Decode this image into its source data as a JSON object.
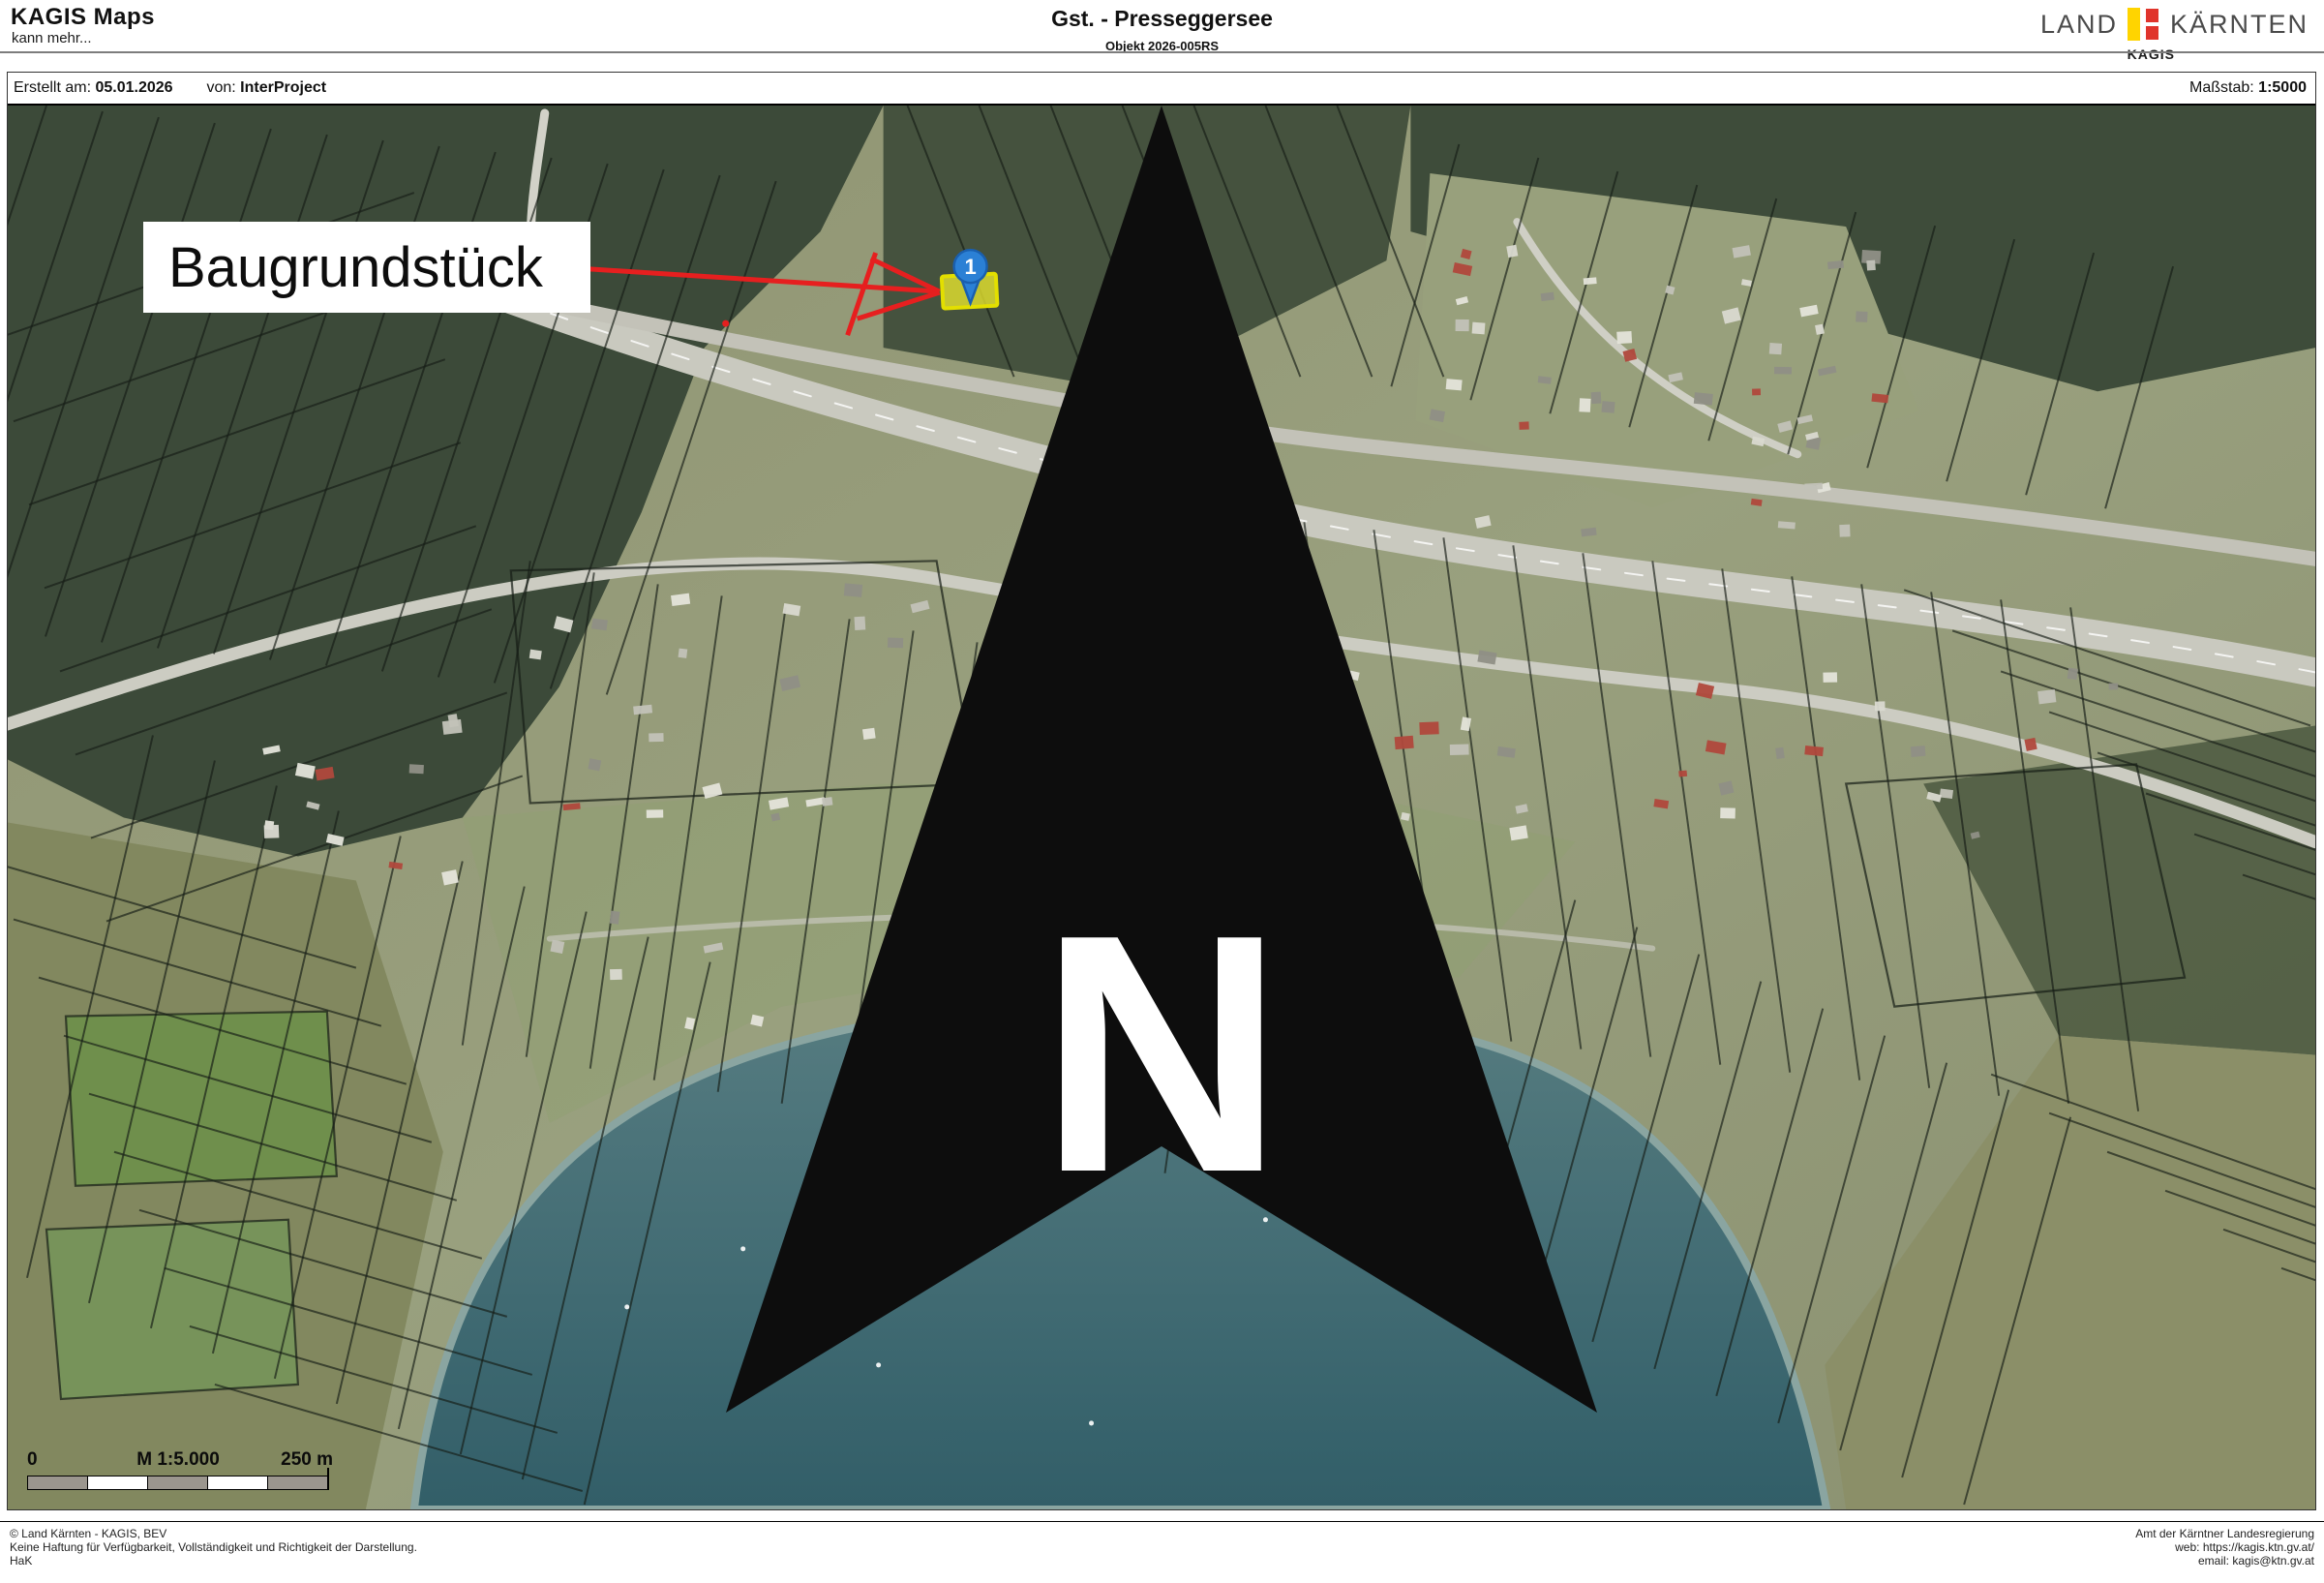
{
  "header": {
    "app_title": "KAGIS Maps",
    "app_subtitle": "kann mehr...",
    "doc_title": "Gst. - Presseggersee",
    "doc_subtitle": "Objekt 2026-005RS",
    "logo": {
      "land": "LAND",
      "kaernten": "KÄRNTEN",
      "kagis": "KAGIS"
    }
  },
  "meta": {
    "created_label": "Erstellt am:",
    "created_value": "05.01.2026",
    "by_label": "von:",
    "by_value": "InterProject",
    "scale_label": "Maßstab:",
    "scale_value": "1:5000"
  },
  "map": {
    "annotation_label": "Baugrundstück",
    "marker_number": "1",
    "place_label": "Hermagor-Pressegger See",
    "north_label": "N",
    "scalebar": {
      "zero": "0",
      "scale_text": "M 1:5.000",
      "distance": "250 m"
    }
  },
  "footer": {
    "left_lines": [
      "© Land Kärnten - KAGIS, BEV",
      "Keine Haftung für Verfügbarkeit, Vollständigkeit und Richtigkeit der Darstellung.",
      "HaK"
    ],
    "right_lines": [
      "Amt der Kärntner Landesregierung",
      "web: https://kagis.ktn.gv.at/",
      "email: kagis@ktn.gv.at"
    ]
  },
  "colors": {
    "accent_red": "#e61f1f",
    "parcel_yellow": "#e9e72e",
    "parcel_yellow_border": "#e3df00",
    "marker_blue": "#2b80d5",
    "place_blue": "#1a16c9",
    "logo_yellow": "#ffd400",
    "logo_red": "#e0342b",
    "lake_top": "#547b81",
    "lake_bottom": "#2f5d68"
  }
}
